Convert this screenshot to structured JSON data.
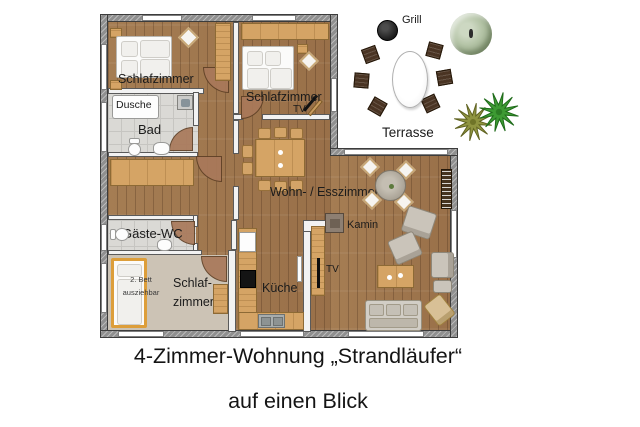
{
  "floorplan": {
    "labels": {
      "bedroom1": "Schlafzimmer",
      "bedroom2": "Schlafzimmer",
      "bedroom2_tv": "TV",
      "shower": "Dusche",
      "bathroom": "Bad",
      "guest_wc": "Gäste-WC",
      "bedroom3_line1": "Schlaf-",
      "bedroom3_line2": "zimmer",
      "extra_bed_line1": "2. Bett",
      "extra_bed_line2": "ausziehbar",
      "kitchen": "Küche",
      "living_dining": "Wohn- / Esszimmer",
      "fireplace": "Kamin",
      "living_tv": "TV",
      "grill": "Grill",
      "terrace": "Terrasse"
    }
  },
  "caption": {
    "line1": "4-Zimmer-Wohnung „Strandläufer“",
    "line2": "auf einen Blick"
  },
  "colors": {
    "floor_wood": "#a0784e",
    "exterior_wall": "#8f8f8f",
    "bathroom_tile": "#dad9d5",
    "bedroom3_carpet": "#ccc3b5",
    "furniture_wood": "#d5a465",
    "terrace_chair_brown": "#4a3423",
    "grill_black": "#1c1c1c",
    "plant_pale_green": "#b2c2a4",
    "plant_olive": "#8f9440",
    "plant_green": "#3d9a33",
    "extra_bed_frame": "#dd9e3a",
    "door_leaf": "#a9795a"
  }
}
